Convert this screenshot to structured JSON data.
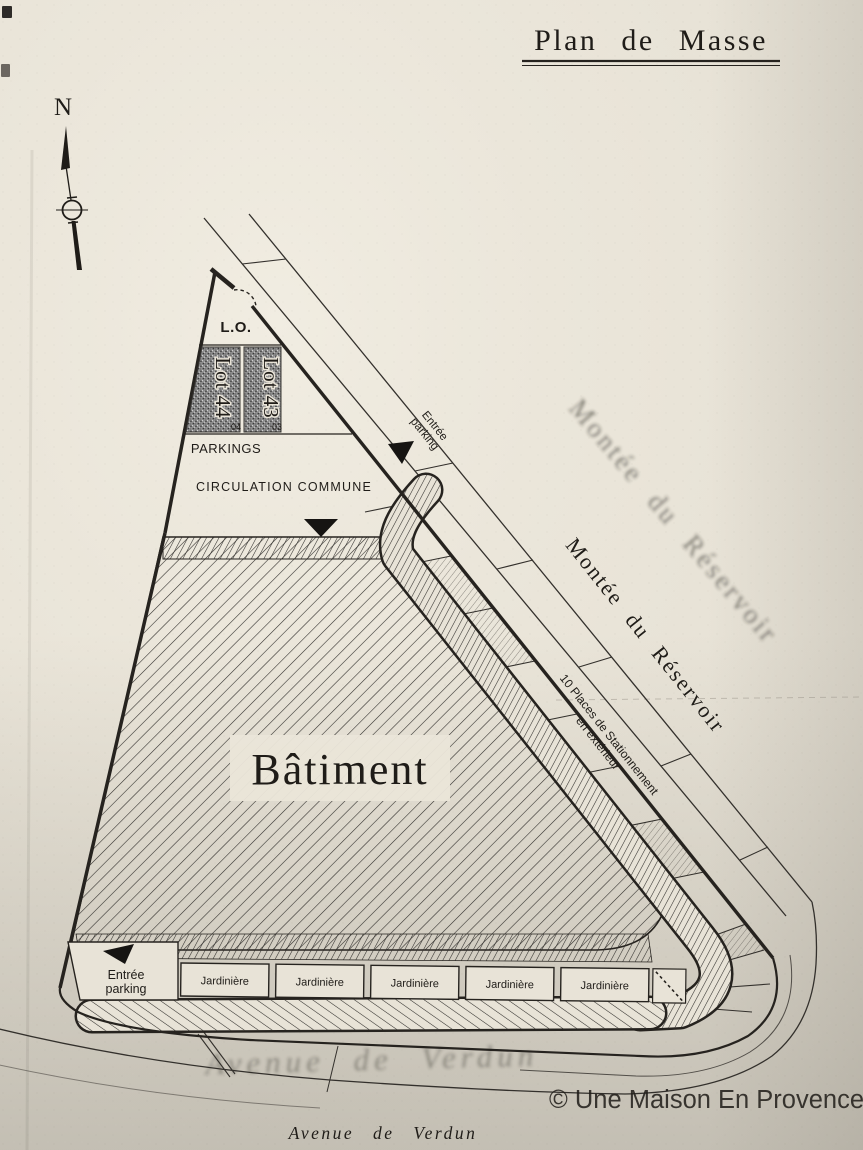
{
  "title": {
    "text": "Plan de Masse"
  },
  "compass": {
    "north_label": "N"
  },
  "streets": {
    "right": "Montée du Réservoir",
    "bottom": "Avenue de Verdun",
    "ghost_right": "Montée du Réservoir",
    "ghost_bottom": "Avenue de Verdun"
  },
  "site": {
    "building_label": "Bâtiment",
    "lo_label": "L.O.",
    "parkings_label": "PARKINGS",
    "circulation_label": "CIRCULATION COMMUNE",
    "lots": [
      {
        "label": "Lot 44",
        "number": "04"
      },
      {
        "label": "Lot 43",
        "number": "03"
      }
    ],
    "entrance_top": {
      "line1": "Entrée",
      "line2": "parking"
    },
    "entrance_bottom": {
      "line1": "Entrée",
      "line2": "parking"
    },
    "parking_note": {
      "line1": "10 Places de Stationnement",
      "line2": "en extérieur"
    },
    "jardinieres": [
      {
        "label": "Jardinière"
      },
      {
        "label": "Jardinière"
      },
      {
        "label": "Jardinière"
      },
      {
        "label": "Jardinière"
      },
      {
        "label": "Jardinière"
      }
    ]
  },
  "watermark": {
    "text": "© Une Maison En Provence"
  },
  "colors": {
    "paper": "#e8e3d7",
    "ink": "#26231f",
    "ghost_text": "#b7b0a3",
    "lot_fill": "#8d8d8d",
    "watermark": "#ffffff"
  }
}
